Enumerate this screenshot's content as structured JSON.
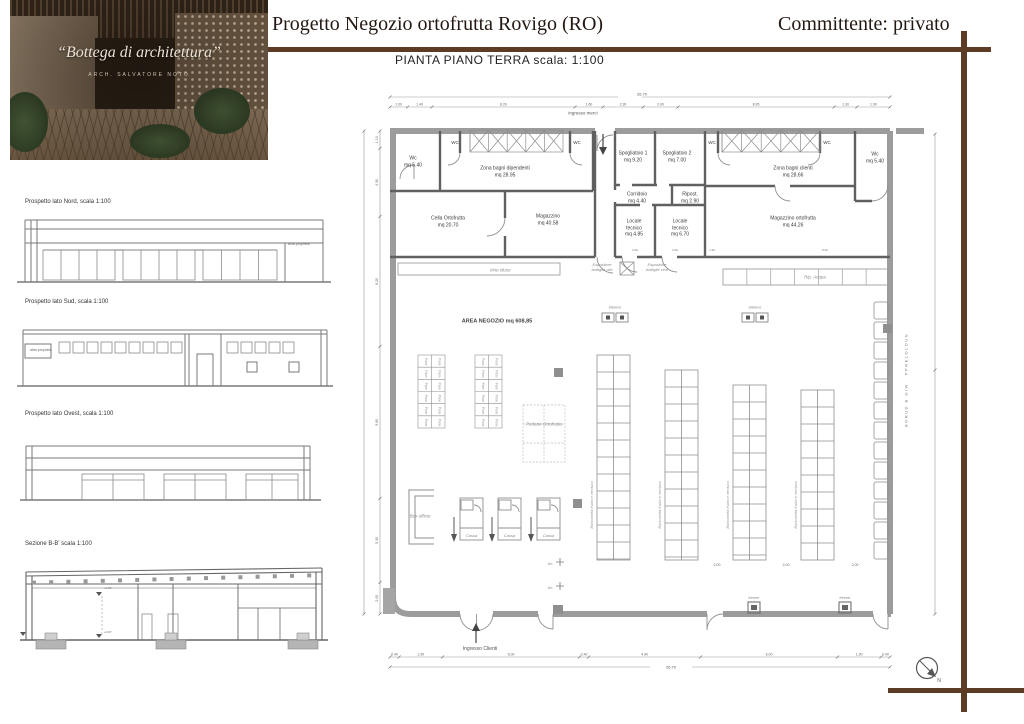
{
  "header": {
    "title": "Progetto Negozio ortofrutta  Rovigo  (RO)",
    "client": "Committente: privato"
  },
  "brand": {
    "name": "“Bottega di architettura”",
    "subtitle": "ARCH. SALVATORE NOTO"
  },
  "elevations": {
    "nord": {
      "label": "Prospetto lato Nord, scala 1:100",
      "note": "altra proprietà"
    },
    "sud": {
      "label": "Prospetto lato Sud, scala 1:100",
      "note": "altra proprietà"
    },
    "ovest": {
      "label": "Prospetto lato Ovest, scala 1:100"
    },
    "sezione": {
      "label": "Sezione B-B' scala 1:100",
      "level_top": "+4.07",
      "level_floor": "+0.07"
    }
  },
  "plan": {
    "title": "PIANTA PIANO TERRA  scala: 1:100",
    "entrances": {
      "merci": "ingresso merci",
      "clienti": "Ingresso Clienti"
    },
    "rooms": {
      "wc_nw": {
        "name": "Wc",
        "mq": "mq 5.40"
      },
      "bagni_dip": {
        "name": "Zona bagni dipendenti",
        "mq": "mq 28.95"
      },
      "wc_small": "WC",
      "spog1": {
        "name": "Spogliatoio 1",
        "mq": "mq 9.20"
      },
      "spog2": {
        "name": "Spogliatoio 2",
        "mq": "mq 7.00"
      },
      "corridoio": {
        "name": "Corridoio",
        "mq": "mq 4.40"
      },
      "ripost": {
        "name": "Ripost.",
        "mq": "mq 2.90"
      },
      "loc_tec1": {
        "name": "Locale\ntecnico",
        "mq": "mq 4.85"
      },
      "loc_tec2": {
        "name": "Locale\ntecnico",
        "mq": "mq 6.70"
      },
      "bagni_cli": {
        "name": "Zona bagni clienti",
        "mq": "mq 28.66"
      },
      "wc_ne": {
        "name": "Wc",
        "mq": "mq 5.40"
      },
      "cella": {
        "name": "Cella Ortofrutta",
        "mq": "mq 20.70"
      },
      "magazzino": {
        "name": "Magazzino",
        "mq": "mq 40.58"
      },
      "mag_orto": {
        "name": "Magazzino ortofrutta",
        "mq": "mq 44.26"
      },
      "negozio": "AREA NEGOZIO mq 608,85"
    },
    "fixtures": {
      "vino_sfuso": "Vino sfuso",
      "esp_olio": "Espositore\nbottiglie olio",
      "esp_vino": "Espositore\nbottiglie vino",
      "rip_acqua": "Rip. Acqua",
      "bilance": "bilance",
      "pane": "Pane",
      "pedane": "Pedane Ortofrutta",
      "bancarella": "Bancarella frutta e verdura",
      "cassa": "Cassa",
      "box_ufficio": "Box ufficio",
      "freezer": "freezer",
      "scale_marker": "2m"
    },
    "dims": {
      "total": "26.70",
      "top": [
        "1.00",
        "1.40",
        "8.20",
        "1.60",
        "2.30",
        "2.00",
        "8.95",
        "1.30",
        "1.90"
      ],
      "bottom": [
        "0.40",
        "1.90",
        "6.00",
        "0.40",
        "4.90",
        "6.00",
        "1.90",
        "0.40"
      ],
      "left": [
        "1.10",
        "4.30",
        "8.20",
        "9.60",
        "5.30",
        "2.00"
      ],
      "mid": [
        "2.00",
        "2.00",
        "1.40",
        "8.00"
      ],
      "racks": [
        "2.00",
        "2.00",
        "2.00"
      ]
    },
    "side_note": "BORUD B GIW · PPRELOLDUN",
    "compass": "N"
  }
}
